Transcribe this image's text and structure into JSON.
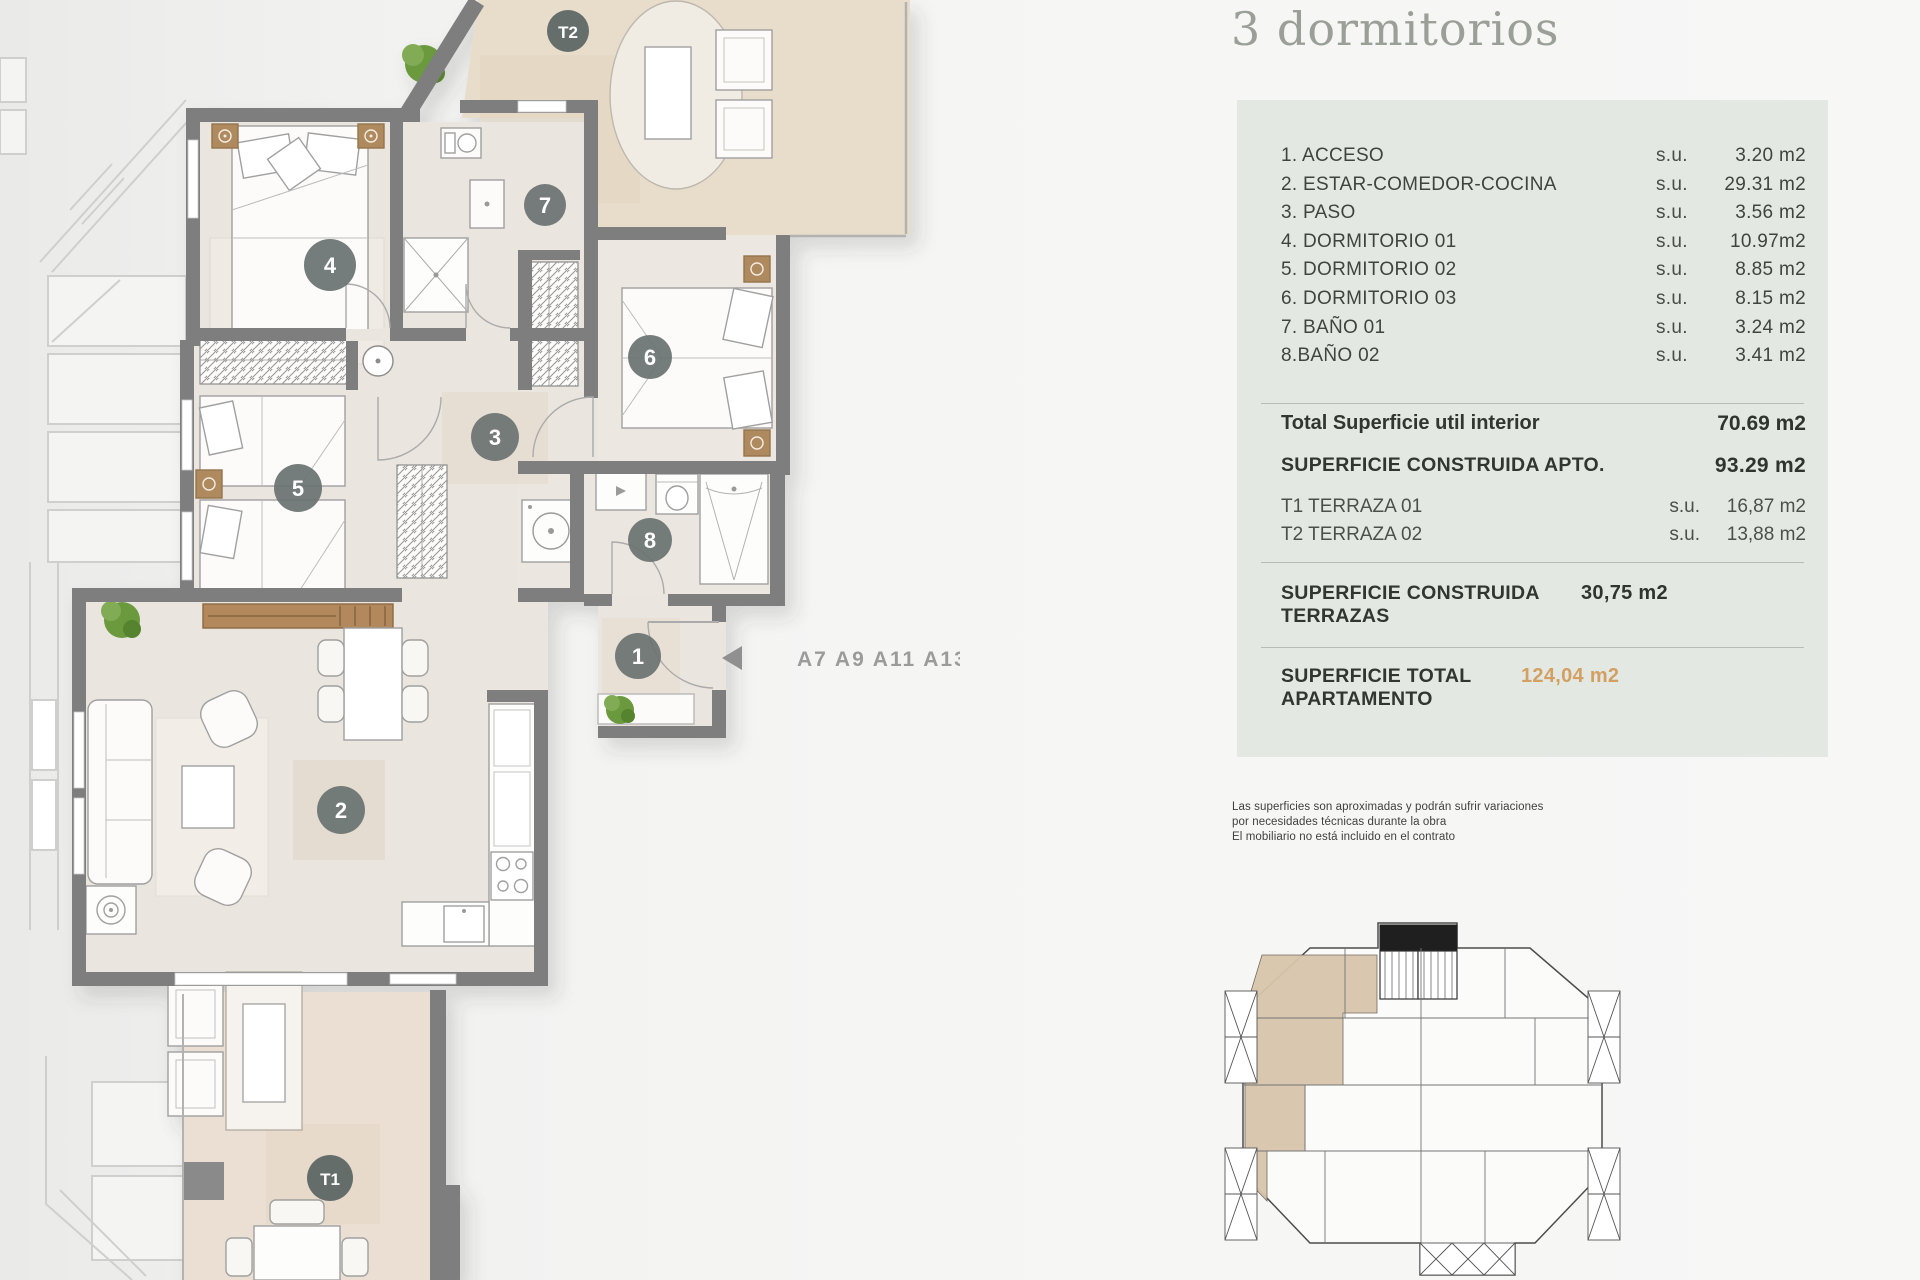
{
  "panel": {
    "title": "3 dormitorios",
    "rooms": [
      {
        "label": "1. ACCESO",
        "su": "s.u.",
        "value": "3.20 m2"
      },
      {
        "label": "2. ESTAR-COMEDOR-COCINA",
        "su": "s.u.",
        "value": "29.31 m2"
      },
      {
        "label": "3. PASO",
        "su": "s.u.",
        "value": "3.56 m2"
      },
      {
        "label": "4. DORMITORIO 01",
        "su": "s.u.",
        "value": "10.97m2"
      },
      {
        "label": "5. DORMITORIO 02",
        "su": "s.u.",
        "value": "8.85 m2"
      },
      {
        "label": "6. DORMITORIO 03",
        "su": "s.u.",
        "value": "8.15 m2"
      },
      {
        "label": "7. BAÑO 01",
        "su": "s.u.",
        "value": "3.24 m2"
      },
      {
        "label": "8.BAÑO 02",
        "su": "s.u.",
        "value": "3.41 m2"
      }
    ],
    "total_interior": {
      "label": "Total Superficie util interior",
      "value": "70.69 m2"
    },
    "construida_apto": {
      "label": "SUPERFICIE CONSTRUIDA APTO.",
      "value": "93.29 m2"
    },
    "terrazas": [
      {
        "label": "T1 TERRAZA 01",
        "su": "s.u.",
        "value": "16,87 m2"
      },
      {
        "label": "T2 TERRAZA 02",
        "su": "s.u.",
        "value": "13,88 m2"
      }
    ],
    "construida_terrazas": {
      "label": "SUPERFICIE CONSTRUIDA TERRAZAS",
      "value": "30,75 m2"
    },
    "total_apartamento": {
      "label": "SUPERFICIE TOTAL APARTAMENTO",
      "value": "124,04 m2"
    },
    "disclaimer": [
      "Las superficies son aproximadas y podrán sufrir variaciones",
      "por necesidades técnicas durante la obra",
      "El mobiliario no está incluido en el contrato"
    ]
  },
  "plan": {
    "room_numbers": [
      "1",
      "2",
      "3",
      "4",
      "5",
      "6",
      "7",
      "8"
    ],
    "terrace_labels": {
      "t1": "T1",
      "t2": "T2"
    },
    "unit_codes": "A7 A9 A11 A13"
  },
  "colors": {
    "accent_orange": "#d2a063",
    "wall_gray": "#7e7e7e",
    "interior_floor": "#eae5de",
    "terrace_tan": "#e8dccb",
    "card_bg": "#e4e8e3",
    "circle_gray": "#6a7372",
    "title_gray_green": "#9aa097"
  }
}
